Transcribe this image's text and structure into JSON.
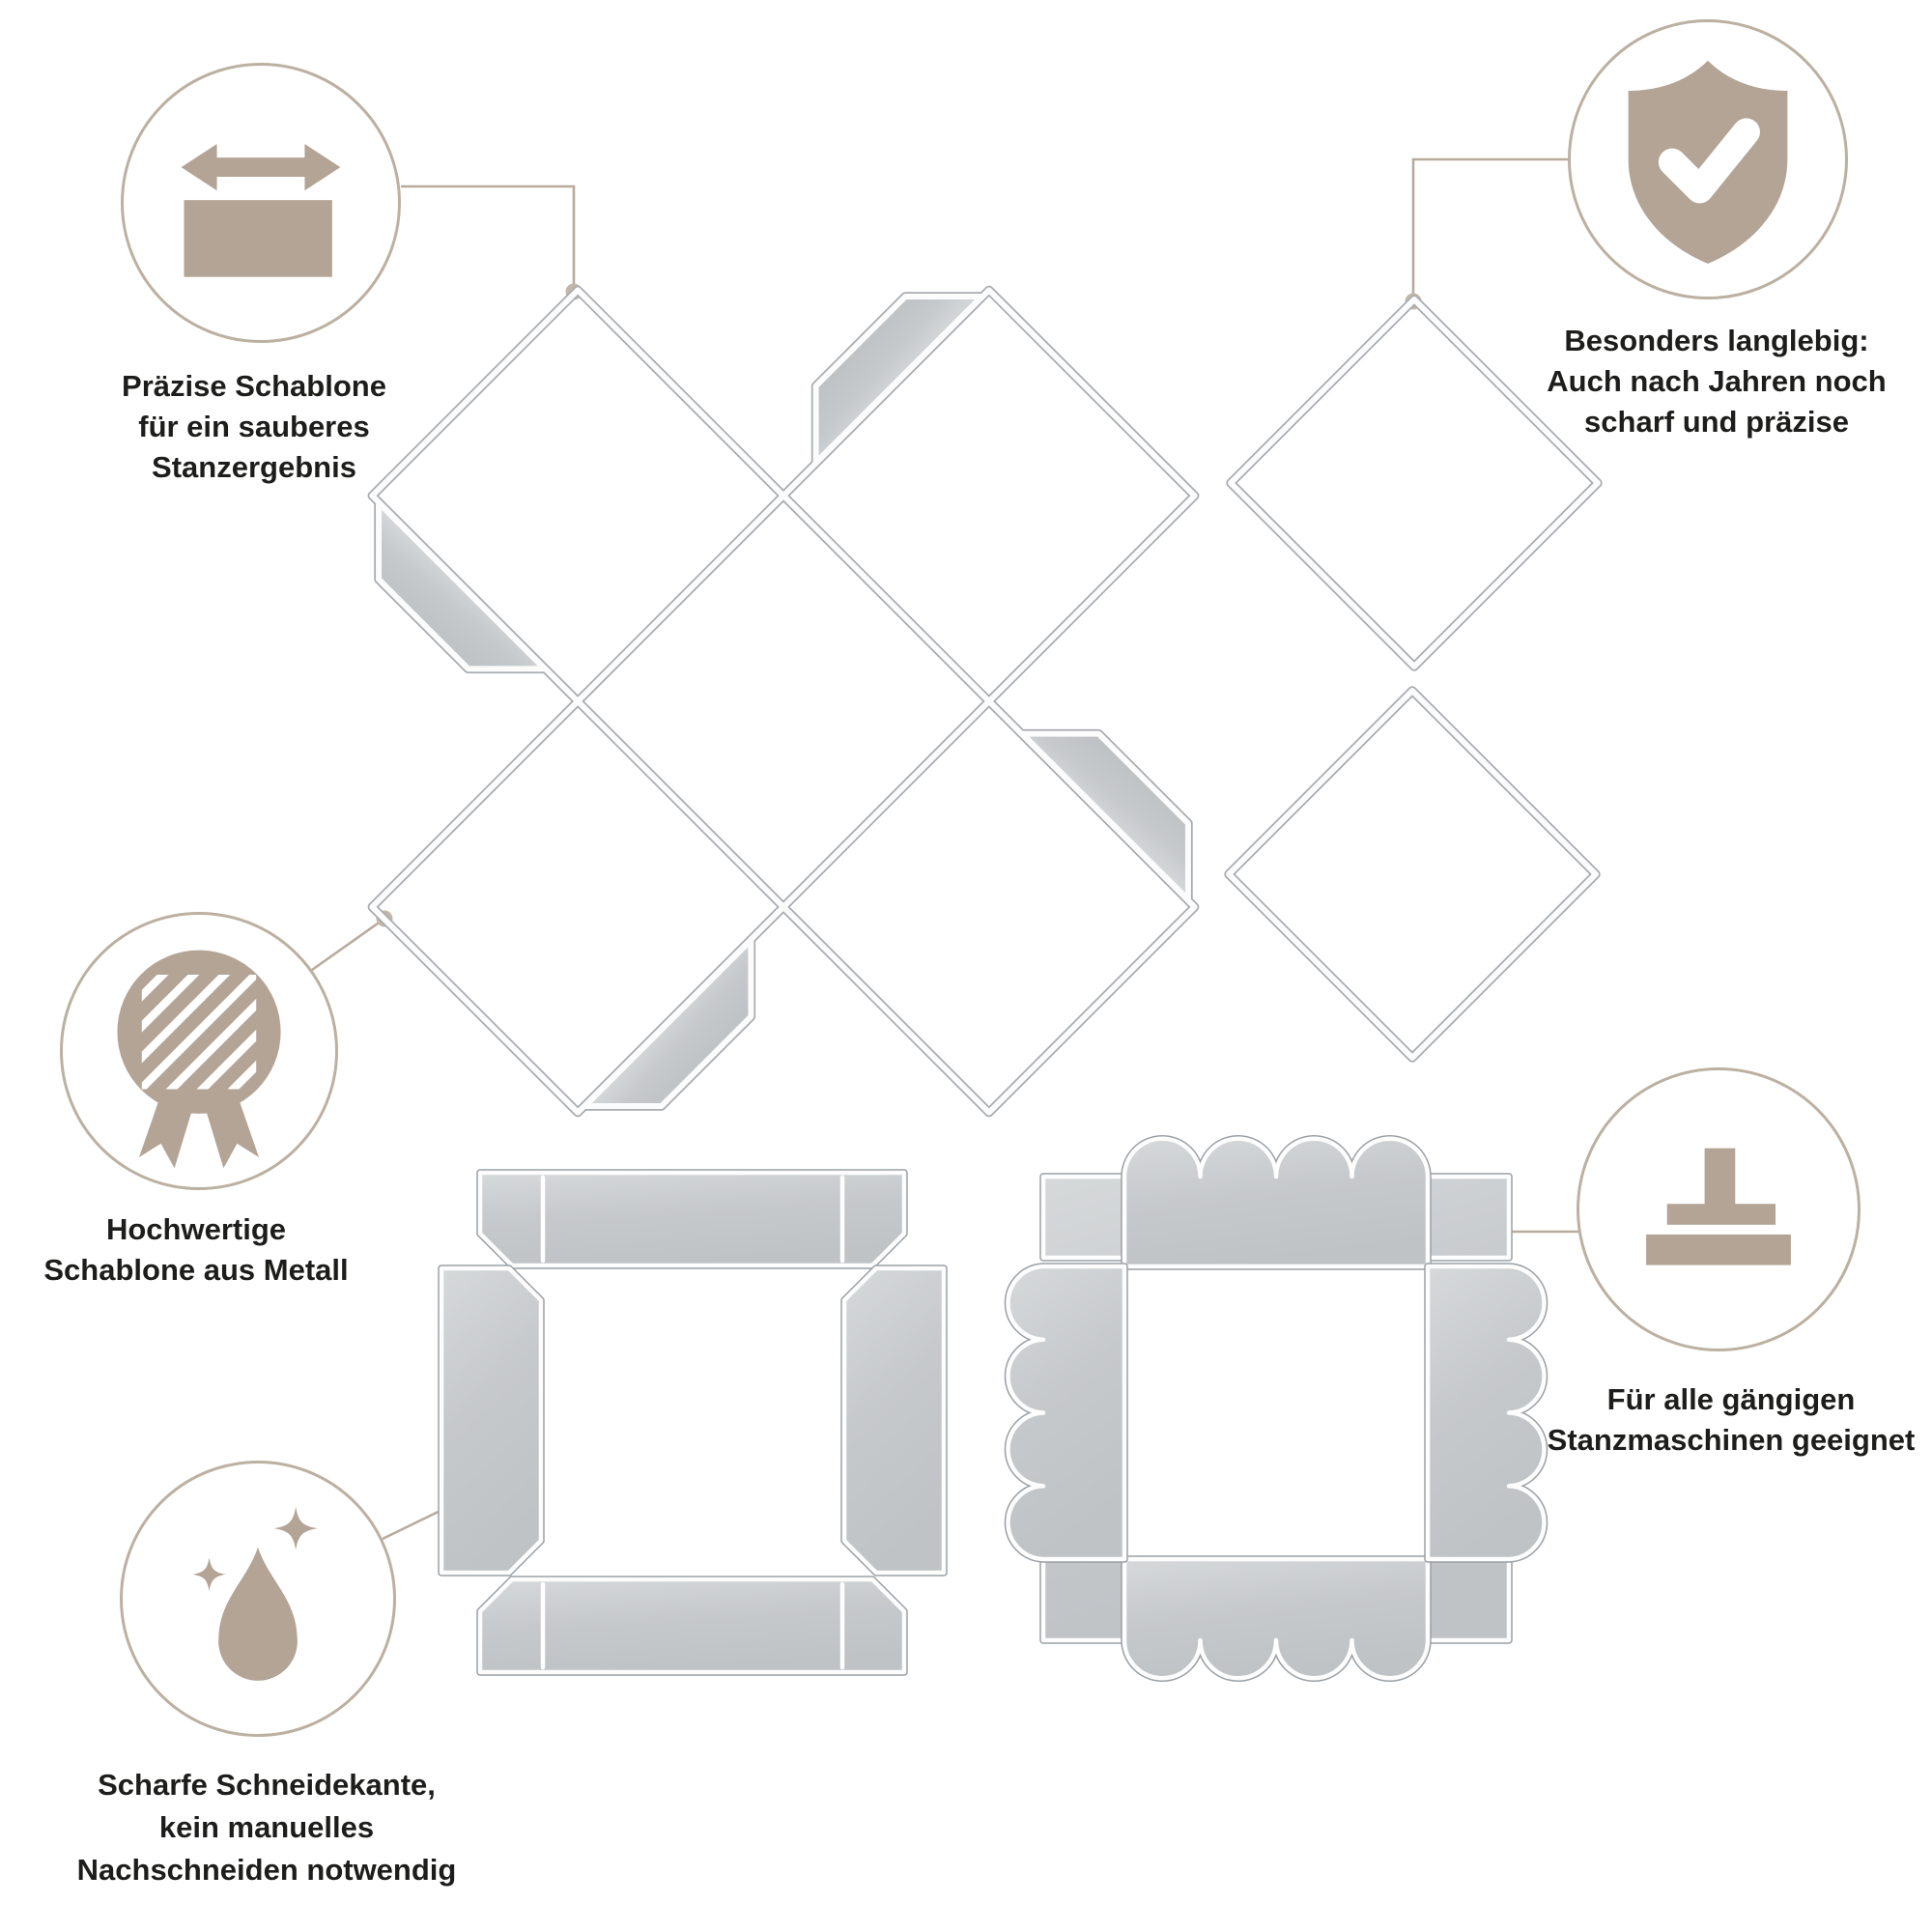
{
  "colors": {
    "background": "#ffffff",
    "accent_beige": "#b3a496",
    "circle_stroke": "#bcb0a1",
    "connector": "#b7ab9d",
    "text": "#1d1d1b",
    "metal_light": "#d6d9da",
    "metal": "#c6c9cc",
    "metal_edge": "#9aa0a5"
  },
  "callouts": [
    {
      "id": "praezise",
      "icon": "width-arrow-icon",
      "lines": [
        "Präzise Schablone",
        "für ein sauberes",
        "Stanzergebnis"
      ]
    },
    {
      "id": "langlebig",
      "icon": "shield-check-icon",
      "lines": [
        "Besonders langlebig:",
        "Auch nach Jahren noch",
        "scharf und präzise"
      ]
    },
    {
      "id": "hochwertig",
      "icon": "medal-icon",
      "lines": [
        "Hochwertige",
        "Schablone aus Metall"
      ]
    },
    {
      "id": "stanzmaschinen",
      "icon": "press-icon",
      "lines": [
        "Für alle gängigen",
        "Stanzmaschinen geeignet"
      ]
    },
    {
      "id": "schneidekante",
      "icon": "drop-sparkles-icon",
      "lines": [
        "Scharfe Schneidekante,",
        "kein manuelles",
        "Nachschneiden notwendig"
      ]
    }
  ],
  "dies": [
    {
      "name": "explosion-box-die"
    },
    {
      "name": "square-frame-die-upper"
    },
    {
      "name": "square-frame-die-lower"
    },
    {
      "name": "box-lid-die-straight"
    },
    {
      "name": "box-lid-die-scalloped"
    }
  ]
}
